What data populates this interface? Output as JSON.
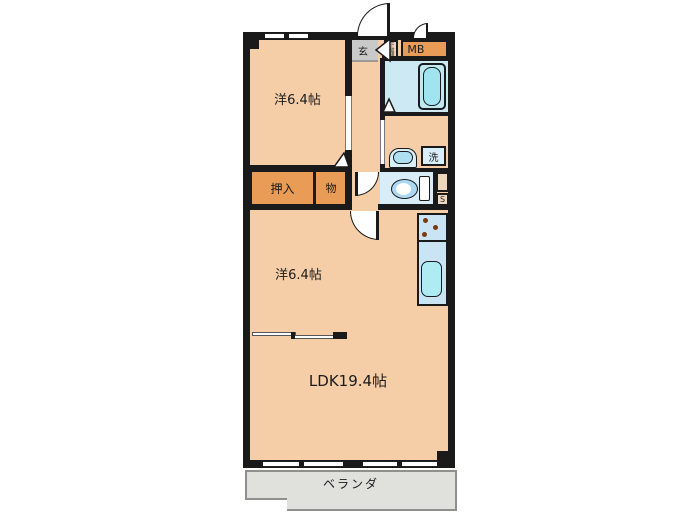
{
  "plan_title": "apartment-floor-plan",
  "labels": {
    "bedroom_top": "洋6.4帖",
    "bedroom_bottom": "洋6.4帖",
    "ldk": "LDK19.4帖",
    "closet": "押入",
    "storage": "物",
    "entrance": "玄",
    "shoe_cabinet": "下駄箱",
    "meter_box": "MB",
    "laundry": "洗",
    "pipe_space": "S",
    "veranda": "ベランダ"
  },
  "colors": {
    "wall": "#1a1a1a",
    "room_fill": "#f5cda7",
    "closet_fill": "#e99c55",
    "wet_area_fill": "#cde9f4",
    "bathtub_fill": "#9fe4ee",
    "kitchen_counter_fill": "#cbe4f4",
    "sink_fill": "#aeebf2",
    "entrance_fill": "#c9c9c9",
    "veranda_fill": "#e0e0dc",
    "burner_dot": "#7a3a10"
  }
}
